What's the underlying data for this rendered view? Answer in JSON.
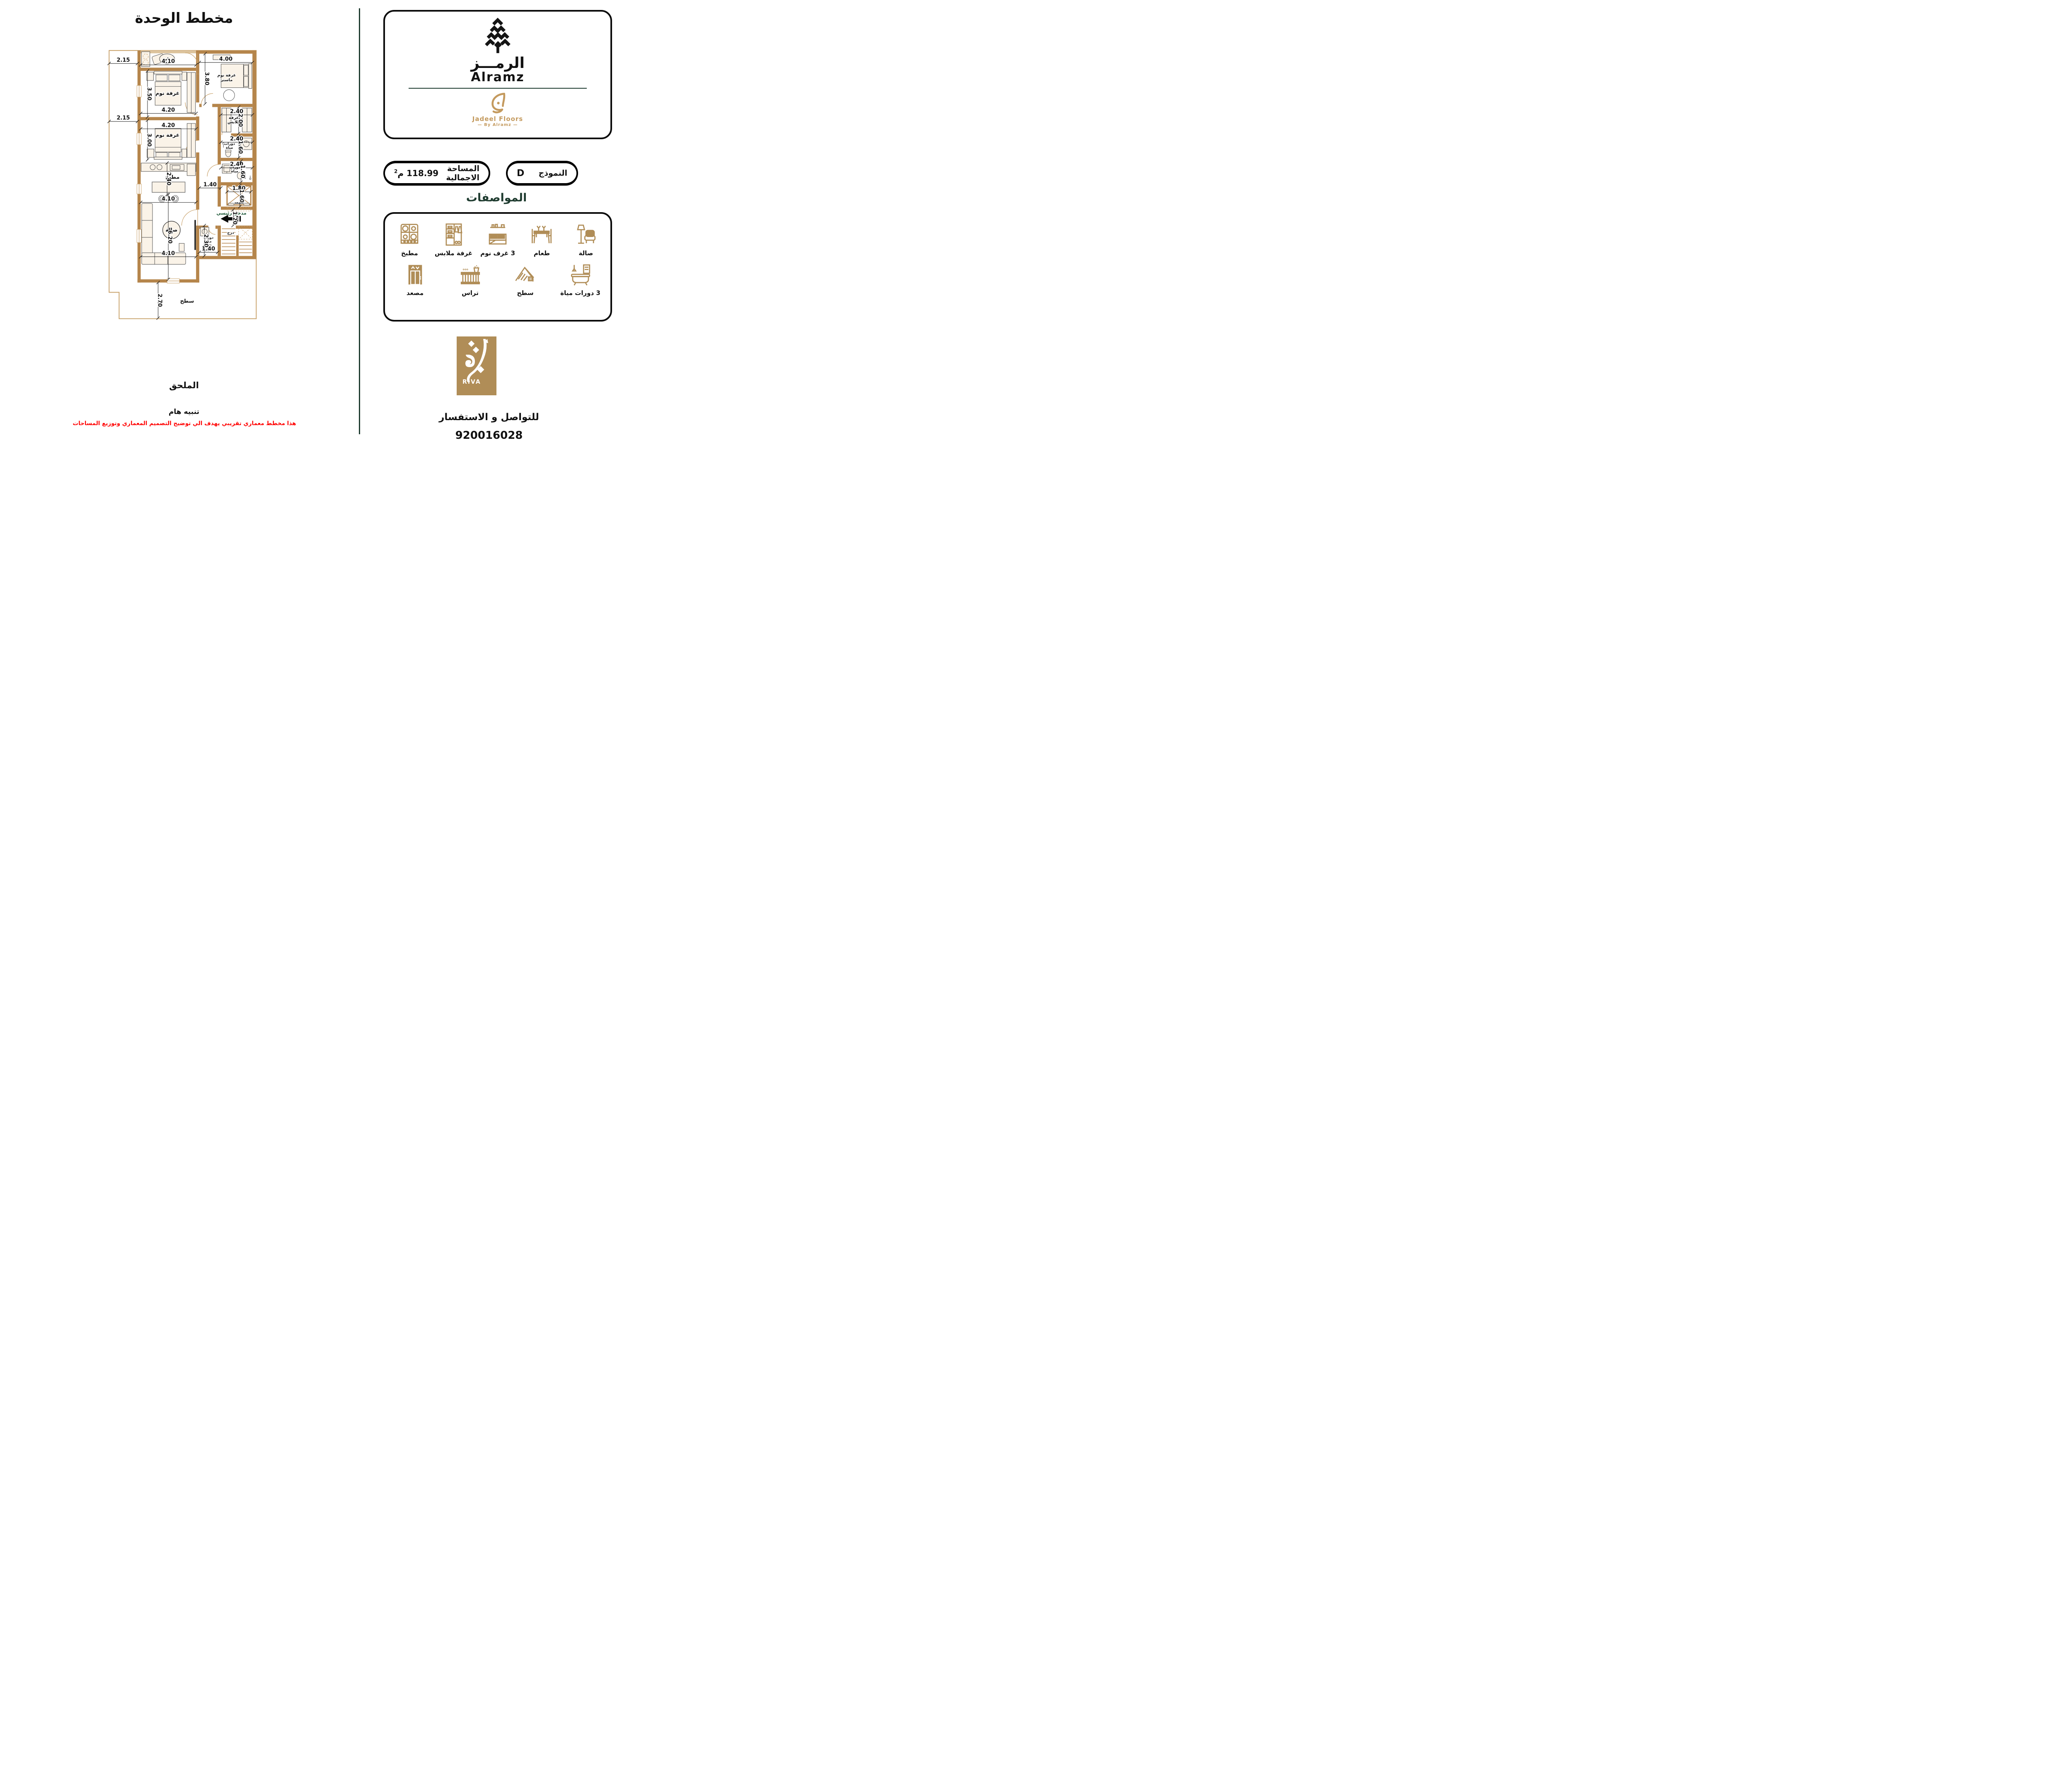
{
  "title": "مخطط الوحدة",
  "annex": {
    "title": "الملحق",
    "notice_heading": "تنبيه هام",
    "notice_text": "هذا مخطط معماري تقريبي يهدف الي توضيح التصميم المعماري وتوزيع المساحات"
  },
  "brand": {
    "wordmark_ar": "الرمـــز",
    "wordmark_en": "Alramz",
    "sub_name": "Jadeel Floors",
    "sub_by": "By Alramz"
  },
  "model": {
    "label": "النموذج",
    "value": "D",
    "area_label": "المساحة الاجمالية",
    "area_value": "118.99",
    "area_unit": "م",
    "area_unit_sup": "2"
  },
  "specs": {
    "heading": "المواصفات",
    "row1": [
      {
        "label": "صالة",
        "icon": "sofa-lamp-icon"
      },
      {
        "label": "طعام",
        "icon": "dining-icon"
      },
      {
        "label": "3 غرف نوم",
        "icon": "bed-icon"
      },
      {
        "label": "غرفة ملابس",
        "icon": "wardrobe-icon"
      },
      {
        "label": "مطبخ",
        "icon": "stove-icon"
      }
    ],
    "row2": [
      {
        "label": "3 دورات مياة",
        "icon": "bathtub-icon"
      },
      {
        "label": "سطح",
        "icon": "roof-icon"
      },
      {
        "label": "تراس",
        "icon": "balcony-icon"
      },
      {
        "label": "مصعد",
        "icon": "elevator-icon"
      }
    ]
  },
  "riva": {
    "name": "RIVA"
  },
  "contact": {
    "label": "للتواصل و الاستفسار",
    "phone": "920016028"
  },
  "plan": {
    "rooms": {
      "terrace": "تراس",
      "bedroom": "غرفة نوم",
      "master_1": "غرفة نوم",
      "master_2": "ماستر",
      "dressing_1": "غرفة",
      "dressing_2": "ملابس",
      "bath_1": "دورات",
      "bath_2": "مياة",
      "kitchen": "مطبخ",
      "living": "صالة",
      "elevator": "مصعد",
      "stairs": "درج",
      "entrance": "مدخل رئيسي",
      "roof": "سطح"
    },
    "dims": [
      "2.15",
      "4.10",
      "4.00",
      "3.80",
      "3.50",
      "4.20",
      "2.15",
      "4.20",
      "3.00",
      "2.40",
      "2.00",
      "2.40",
      "1.60",
      "2.40",
      "1.60",
      "2.40",
      "1.40",
      "1.80",
      "1.60",
      "1.20",
      "4.10",
      "6.20",
      "4.10",
      "2.30",
      "1.40",
      "2.70"
    ]
  }
}
